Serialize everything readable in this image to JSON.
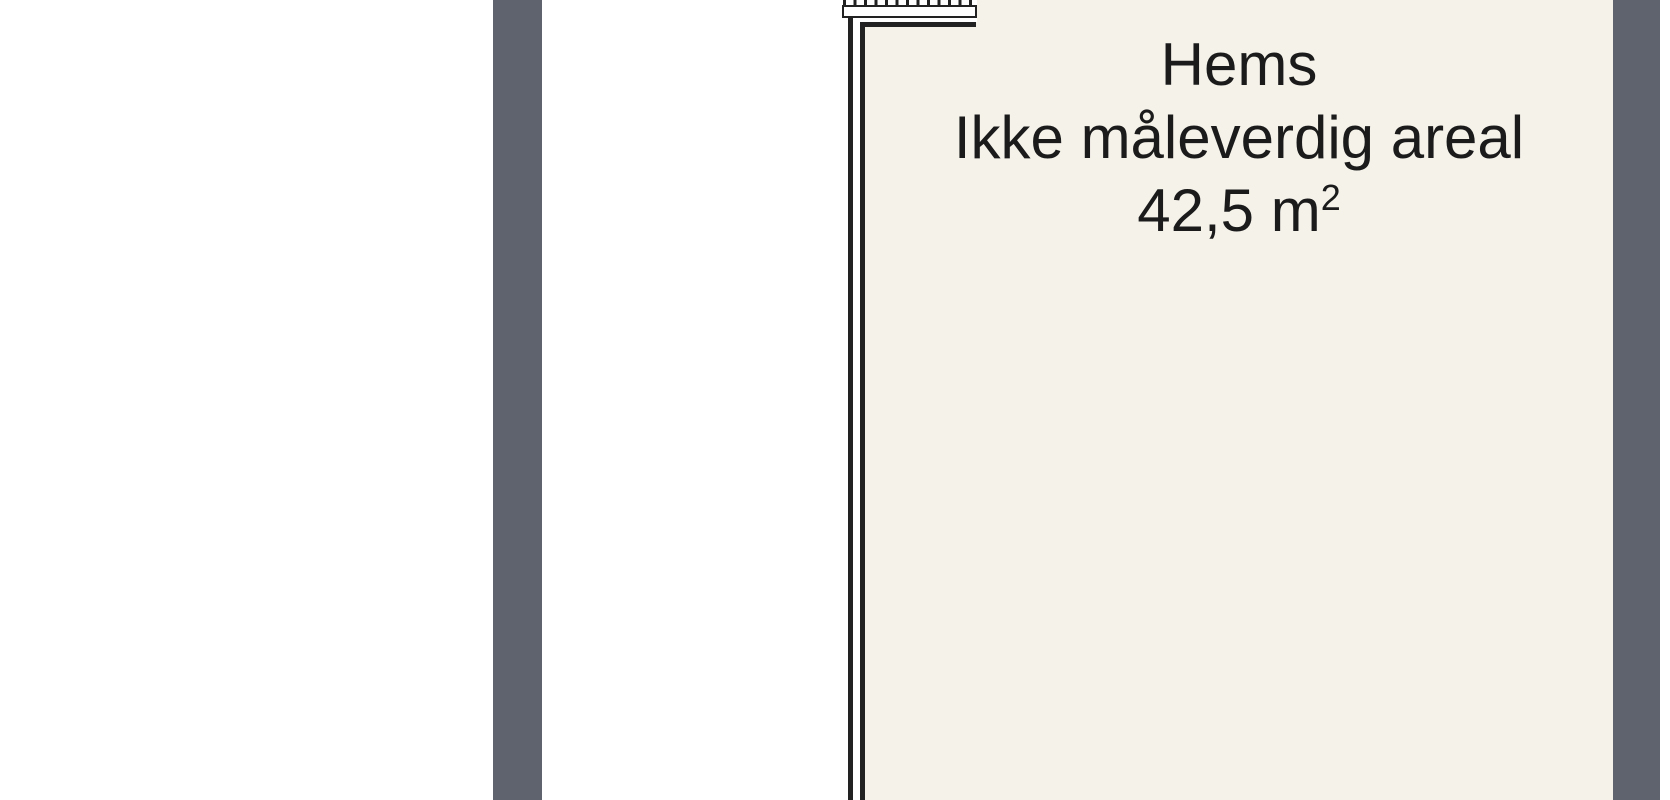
{
  "room": {
    "name": "Hems",
    "note": "Ikke måleverdig areal",
    "area_value": "42,5 m",
    "area_superscript": "2"
  },
  "colors": {
    "background": "#ffffff",
    "wall_section_gray": "#5f636e",
    "room_floor_cream": "#f5f2ea",
    "wall_line_dark": "#222222",
    "text_dark": "#1b1b1b"
  },
  "icons": {
    "stair_hatch": "vertical-tick-hatching"
  }
}
